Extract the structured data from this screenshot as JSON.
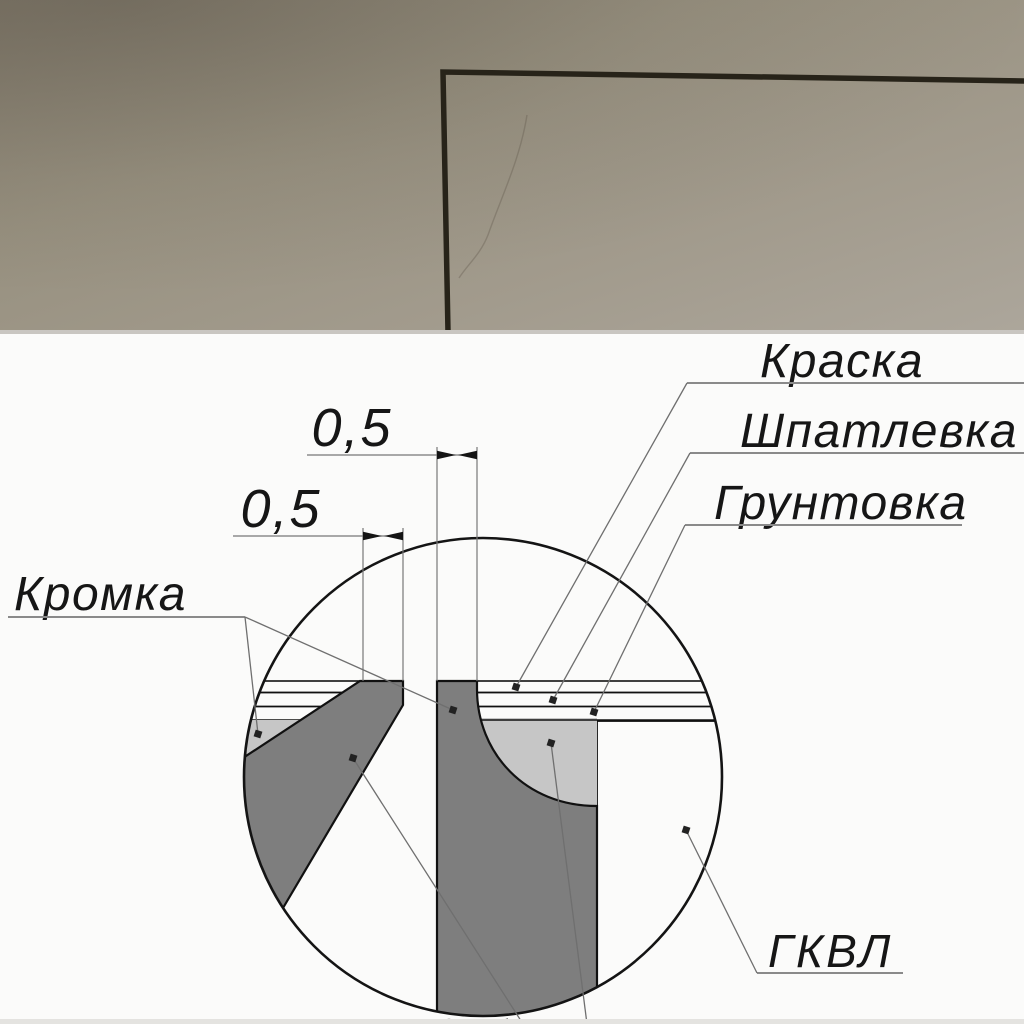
{
  "photo": {
    "colors": {
      "wall_dark": "#877f6f",
      "wall_mid": "#9b9486",
      "wall_light": "#aba59a",
      "frame_line": "#272319"
    }
  },
  "diagram": {
    "dimensions": {
      "top": "0,5",
      "left": "0,5"
    },
    "labels": {
      "paint": "Краска",
      "filler": "Шпатлевка",
      "primer": "Грунтовка",
      "edge": "Кромка",
      "board": "ГКВЛ"
    },
    "colors": {
      "background": "#fbfbfa",
      "paint": "#f3bac3",
      "filler_band": "#c9c9c9",
      "primer_band": "#6f6f6f",
      "putty_fill": "#c6c6c6",
      "board_green": "#c9f1c3",
      "core_gray": "#7e7e7e"
    }
  }
}
